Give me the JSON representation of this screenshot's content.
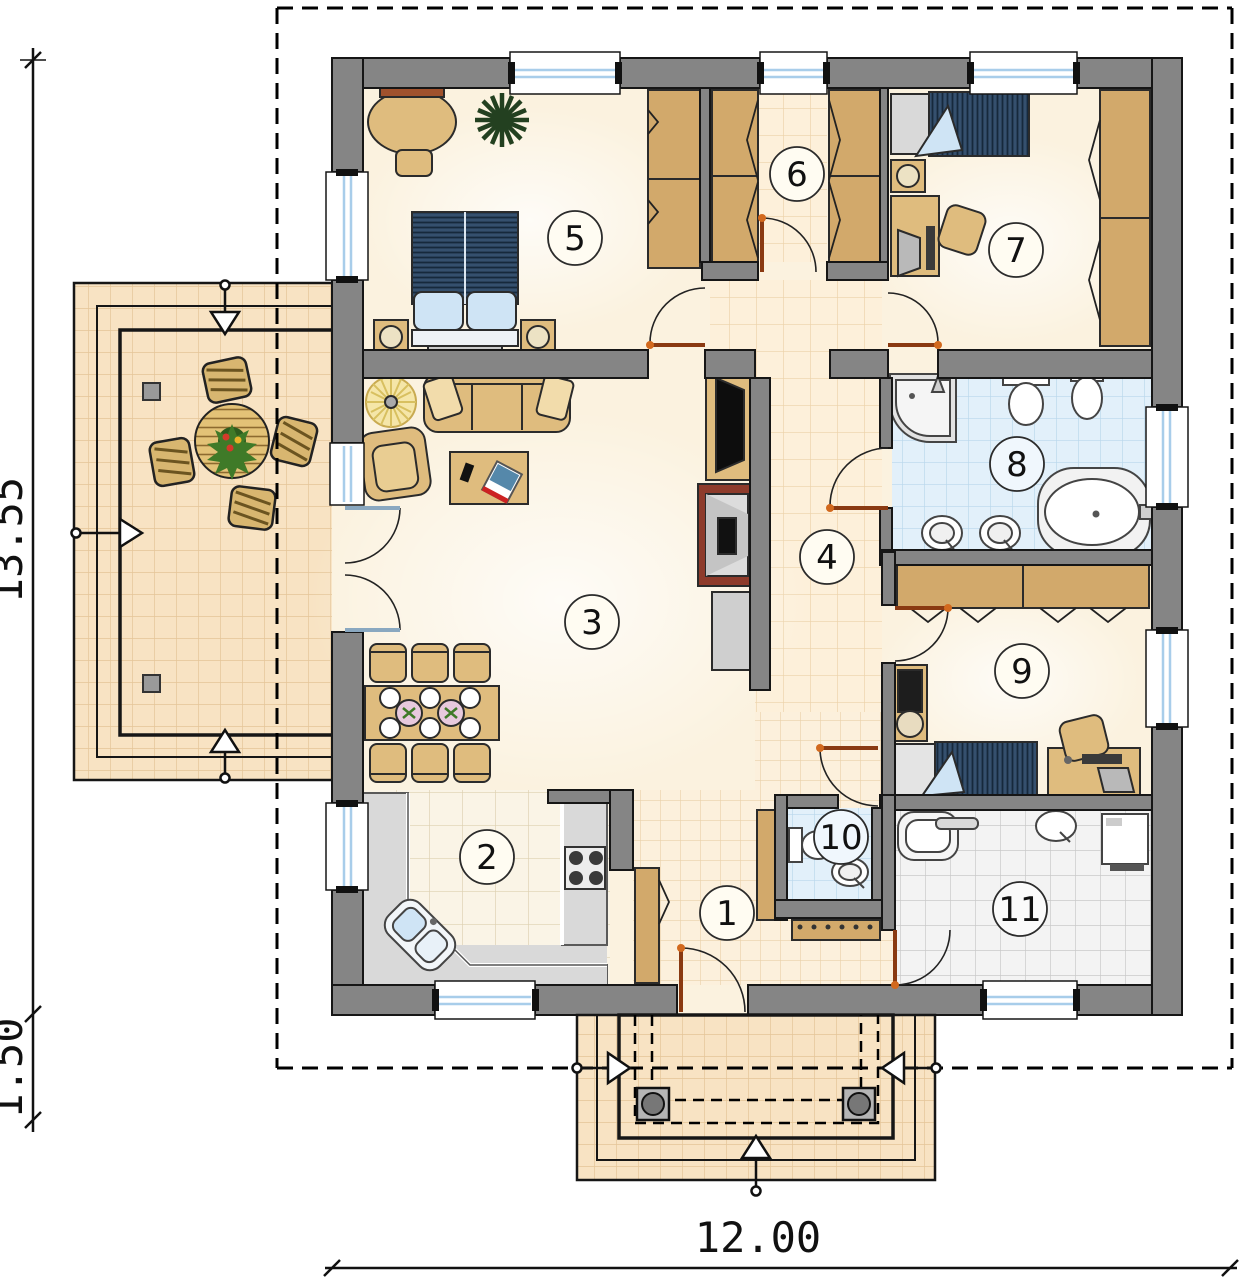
{
  "plan": {
    "dims": {
      "total_height": "13.55",
      "porch_depth": "1.50",
      "total_width": "12.00"
    },
    "rooms": [
      {
        "number": "1"
      },
      {
        "number": "2"
      },
      {
        "number": "3"
      },
      {
        "number": "4"
      },
      {
        "number": "5"
      },
      {
        "number": "6"
      },
      {
        "number": "7"
      },
      {
        "number": "8"
      },
      {
        "number": "9"
      },
      {
        "number": "10"
      },
      {
        "number": "11"
      }
    ],
    "palette": {
      "wall": "#858585",
      "outline": "#161616",
      "floor_cream": "#fbf2df",
      "tile_warm": "#f8e3c3",
      "tile_warm_grout": "#e4c598",
      "tile_blue": "#e2f0fa",
      "tile_blue_grout": "#b9d7ec",
      "tile_gray": "#f3f3f3",
      "tile_gray_grout": "#c9c9c9",
      "wood": "#dfbc7e",
      "wardrobe_wood": "#d2a96b",
      "bed_navy": "#35506e",
      "pillow_blue": "#cfe4f5",
      "door_leaf": "#8a3a12",
      "window_glass": "#a8cdea",
      "fireplace": "#8e3b2b",
      "counter_gray": "#d9d9d9"
    }
  }
}
